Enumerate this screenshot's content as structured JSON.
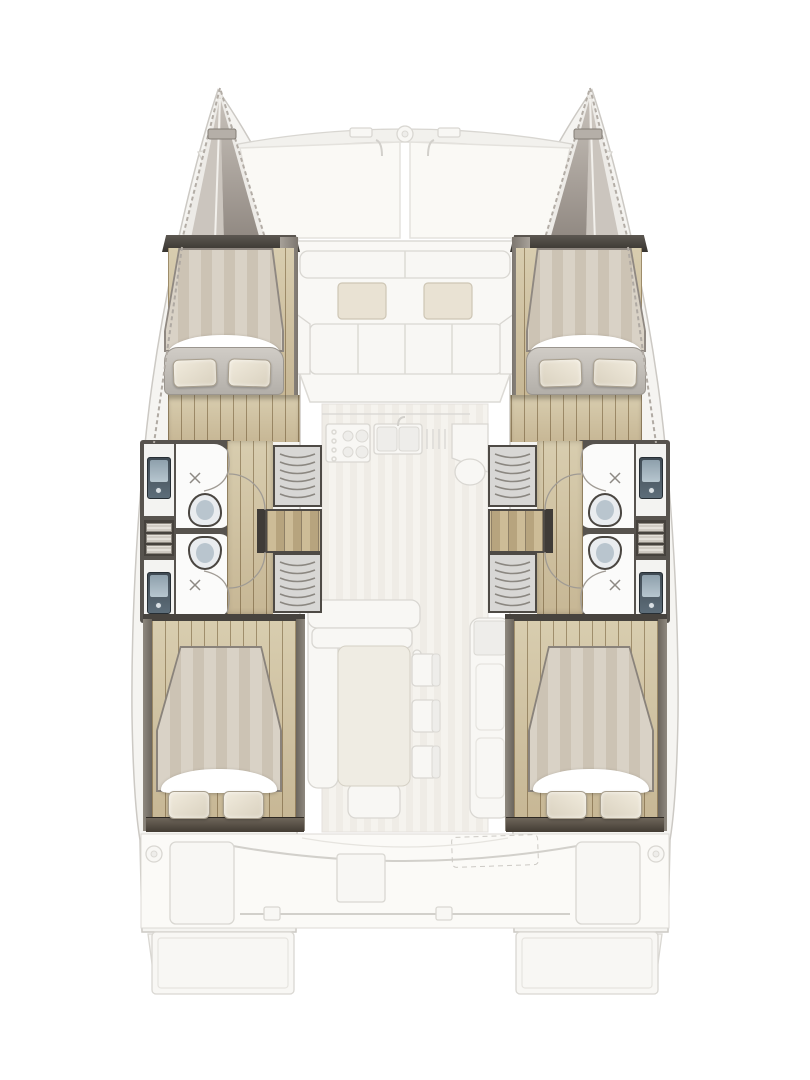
{
  "page": {
    "background": "#ffffff",
    "content": "top-down floor plan of a sailing catamaran; ghosted main deck over highlighted hull accommodations; no text labels rendered"
  },
  "palette": {
    "paper": "#ffffff",
    "ghost_line": "#d9d7d2",
    "ghost_fill": "#f8f7f4",
    "cushion": "#e9e2d3",
    "cushion_edge": "#cec6b5",
    "wall_dark": "#57534e",
    "wood_a": "#d8cdaf",
    "wood_b": "#c7b795",
    "duvet_a": "#d9d2c6",
    "duvet_b": "#ccc3b4",
    "sheet": "#ffffff",
    "pillow_a": "#f1ebdd",
    "pillow_b": "#d9d1bf",
    "pillow_edge": "#a89f8e",
    "bath_floor": "#f3f3f1",
    "wet_white": "#fbfbfa",
    "sink_a": "#3f4a53",
    "sink_b": "#5d6d79",
    "sink_glass": "#b7c6cf",
    "toilet_body": "#e9ecef",
    "toilet_seat": "#b9c5ce",
    "louver_bg": "#d8d7d5",
    "louver_line": "#8b8781",
    "stair_a": "#cdbc97",
    "stair_b": "#b7a47e",
    "shelf_a": "#6e655a",
    "shelf_b": "#423b33"
  },
  "vessel": {
    "type": "catamaran",
    "view": "overhead deck and hull layout",
    "symmetry": "port and starboard hulls mirrored about centerline",
    "deck_ghost": {
      "bow": [
        "port bow tip with cleat",
        "starboard bow tip with cleat",
        "curved forward crossbeam",
        "center windlass fitting",
        "two trampoline panels"
      ],
      "foredeck_cockpit": [
        "backrest band (2 panels)",
        "2 loose cushions",
        "bench seat (4 panels)",
        "2 angled side seats"
      ],
      "galley": [
        "counter",
        "stove with 4 burners",
        "double sink with faucet",
        "drainer grooves",
        "angled console",
        "round basin"
      ],
      "dining": [
        "L-shaped sofa",
        "rectangular table",
        "3 chairs",
        "aft bench",
        "tall fridge column with top locker"
      ],
      "aft_cockpit": [
        "full-width bench curve",
        "2 seat lockers",
        "center hatch",
        "dashed liferaft outline",
        "traveler track with 2 cars",
        "2 stern post fittings",
        "2 davit arms",
        "2 swim platforms"
      ]
    },
    "hull_spaces": {
      "forward_cabin": {
        "berth": "double V-berth",
        "duvet": "striped",
        "pillows": 2,
        "footboard": 1,
        "floor": "plank sole"
      },
      "bathrooms": {
        "count": 2,
        "each": [
          "vanity washbasin with faucet",
          "shower floor with X drain and curved glass door",
          "marine toilet"
        ],
        "between": "linen cubby with 3 slatted shelves"
      },
      "corridor": "plank sole walkway with 2 door swing arcs",
      "storage": {
        "louvered_wardrobes": 2,
        "companionway_steps": 1
      },
      "aft_cabin": {
        "berth": "double berth",
        "duvet": "striped",
        "pillows": 2,
        "aft_shelf": 1
      }
    }
  }
}
